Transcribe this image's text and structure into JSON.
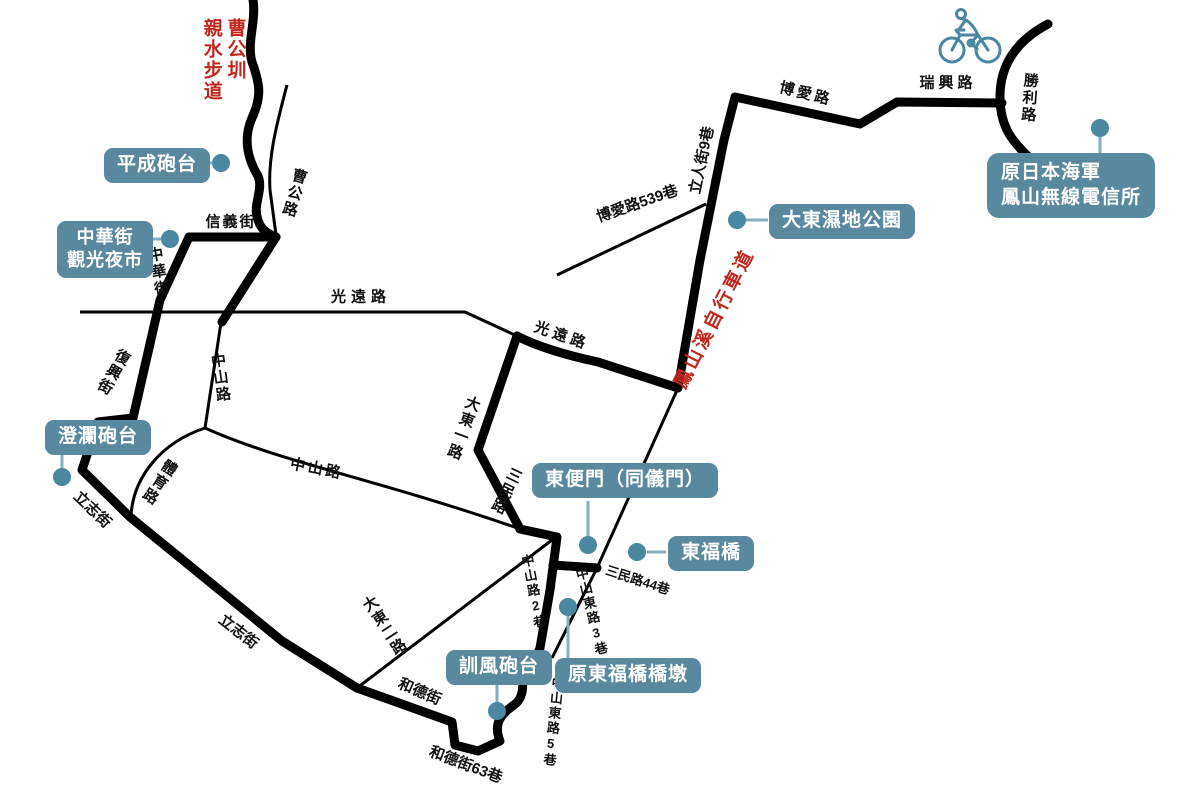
{
  "colors": {
    "road": "#000000",
    "badge_bg": "#58899e",
    "badge_text": "#ffffff",
    "dot": "#4a87a0",
    "connector": "#85aec2",
    "accent_red": "#c0281e",
    "cyclist": "#4a87a0"
  },
  "canal_walk_label": {
    "line1": "曹公圳",
    "line2": "親水步道"
  },
  "bikeway_label": {
    "text": "鳳山溪自行車道"
  },
  "road_labels": [
    "曹公路",
    "信義街",
    "中華街",
    "復興街",
    "光遠路",
    "光遠路",
    "中山路",
    "中山路",
    "體育路",
    "大東一路",
    "三民路",
    "立志街",
    "立志街",
    "大東二路",
    "和德街",
    "和德街63巷",
    "中山東路5巷",
    "中山路2巷",
    "中山東路3巷",
    "三民路44巷",
    "博愛路539巷",
    "立人街9巷",
    "博愛路",
    "瑞興路",
    "勝利路"
  ],
  "poi": [
    {
      "label": "平成砲台"
    },
    {
      "lines": [
        "中華街",
        "觀光夜市"
      ]
    },
    {
      "label": "澄瀾砲台"
    },
    {
      "label": "東便門（同儀門）"
    },
    {
      "label": "東福橋"
    },
    {
      "label": "訓風砲台"
    },
    {
      "label": "原東福橋橋墩"
    },
    {
      "label": "大東濕地公園"
    },
    {
      "lines": [
        "原日本海軍",
        "鳳山無線電信所"
      ]
    }
  ]
}
